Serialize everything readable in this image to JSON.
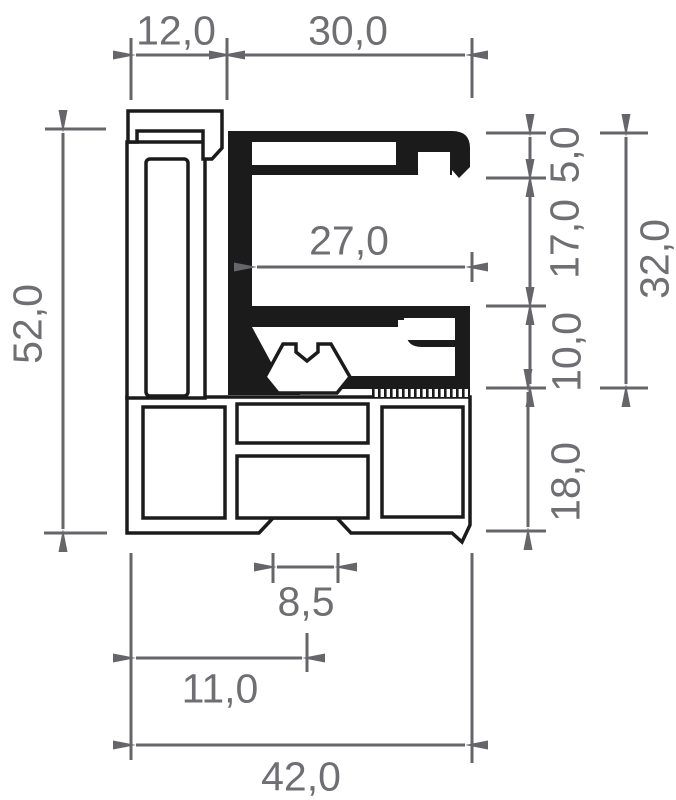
{
  "drawing": {
    "dim_12": "12,0",
    "dim_30": "30,0",
    "dim_27": "27,0",
    "dim_5": "5,0",
    "dim_17": "17,0",
    "dim_10": "10,0",
    "dim_32": "32,0",
    "dim_18": "18,0",
    "dim_52": "52,0",
    "dim_8_5": "8,5",
    "dim_11": "11,0",
    "dim_42": "42,0"
  },
  "colors": {
    "dimension_lines": "#66666a",
    "dimension_text": "#6f6f73",
    "profile_fill_dark": "#1b1b1b",
    "profile_outline": "#1b1b1b",
    "background": "#ffffff"
  }
}
